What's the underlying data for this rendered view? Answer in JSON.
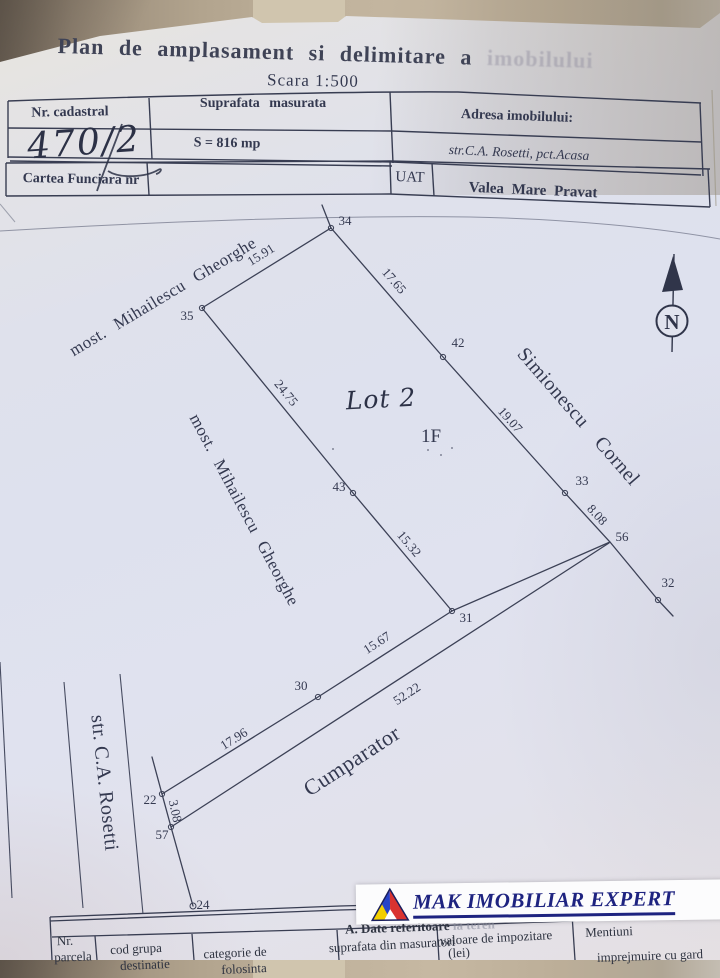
{
  "title": {
    "full": "Plan de amplasament si delimitare a imobilului",
    "visible_part": "Plan de amplasament si delimitare a",
    "faded_part": "imobilului",
    "scale": "Scara 1:500"
  },
  "header_table": {
    "nr_cadastral_label": "Nr. cadastral",
    "nr_cadastral_value": "470/2",
    "suprafata_label": "Suprafata masurata",
    "suprafata_value": "S = 816 mp",
    "adresa_label": "Adresa imobilului:",
    "adresa_value": "str.C.A. Rosetti, pct.Acasa",
    "cartea_funciara_label": "Cartea Funciara nr",
    "uat_label": "UAT",
    "uat_value": "Valea Mare Pravat"
  },
  "plan": {
    "lot_label": "Lot 2",
    "building_label": "1F",
    "north_label": "N",
    "neighbor_nw": "most. Mihailescu Gheorghe",
    "neighbor_w": "most. Mihailescu Gheorghe",
    "neighbor_e": "Simionescu Cornel",
    "neighbor_s": "Cumparator",
    "street": "str. C.A. Rosetti",
    "point_labels": [
      "34",
      "35",
      "42",
      "33",
      "56",
      "32",
      "31",
      "43",
      "30",
      "22",
      "57",
      "24"
    ],
    "dimension_labels": [
      "15.91",
      "17.65",
      "19.07",
      "8.08",
      "24.75",
      "15.32",
      "15.67",
      "17.96",
      "52.22",
      "3.08"
    ]
  },
  "footer_table": {
    "section_title_visible": "A. Date referitoare",
    "section_title_faded": "la teren",
    "col_nr_line1": "Nr.",
    "col_nr_line2": "parcela",
    "col_cod_line1": "cod grupa",
    "col_cod_line2": "destinatie",
    "col_categorie_line1": "categorie de",
    "col_categorie_line2": "folosinta",
    "col_suprafata": "suprafata din masuratori",
    "col_valoare_line1": "valoare de impozitare",
    "col_valoare_line2": "(lei)",
    "col_mentiuni": "Mentiuni",
    "mentiuni_value": "imprejmuire cu gard"
  },
  "logo": {
    "text": "MAK IMOBILIAR EXPERT"
  },
  "colors": {
    "paper": "#e0e2ee",
    "ink": "#343950",
    "logo_navy": "#1e2380",
    "logo_blue": "#2743c8",
    "logo_red": "#d93330",
    "logo_yellow": "#f2cf00",
    "background_tan": "#b3a692"
  }
}
